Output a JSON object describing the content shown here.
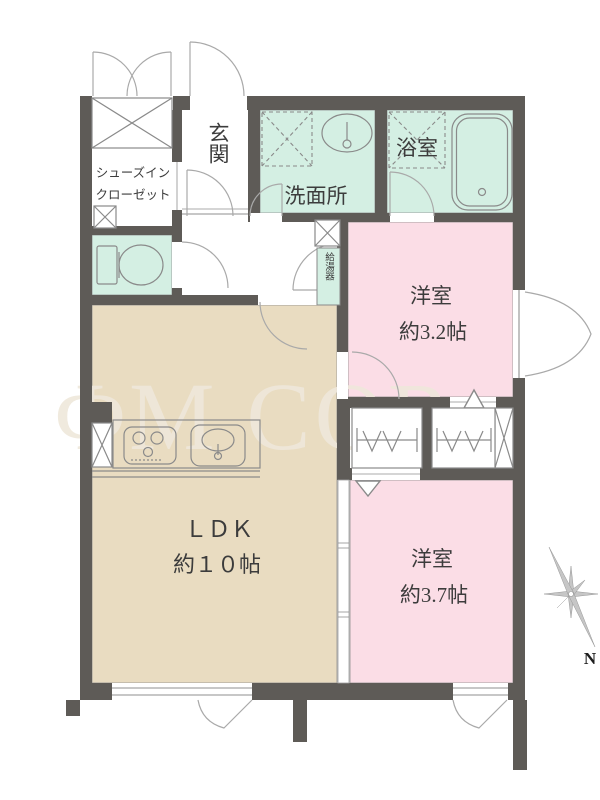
{
  "colors": {
    "wall": "#5e5b57",
    "wet": "#d4efe3",
    "bedroom": "#fbdde6",
    "ldk": "#e9dcc1",
    "line": "#8f8f8f",
    "fixture": "#8a8a8a",
    "watermark": "#efe8db"
  },
  "rooms": {
    "entrance": "玄関",
    "shoes_closet_line1": "シューズイン",
    "shoes_closet_line2": "クローゼット",
    "washroom": "洗面所",
    "bathroom": "浴室",
    "water_heater": "給湯器",
    "bedroom1_name": "洋室",
    "bedroom1_size": "約3.2帖",
    "ldk_name": "ＬＤＫ",
    "ldk_size": "約１０帖",
    "bedroom2_name": "洋室",
    "bedroom2_size": "約3.7帖"
  },
  "compass": {
    "north_label": "N"
  },
  "watermark": {
    "text": "ΦM COR"
  }
}
